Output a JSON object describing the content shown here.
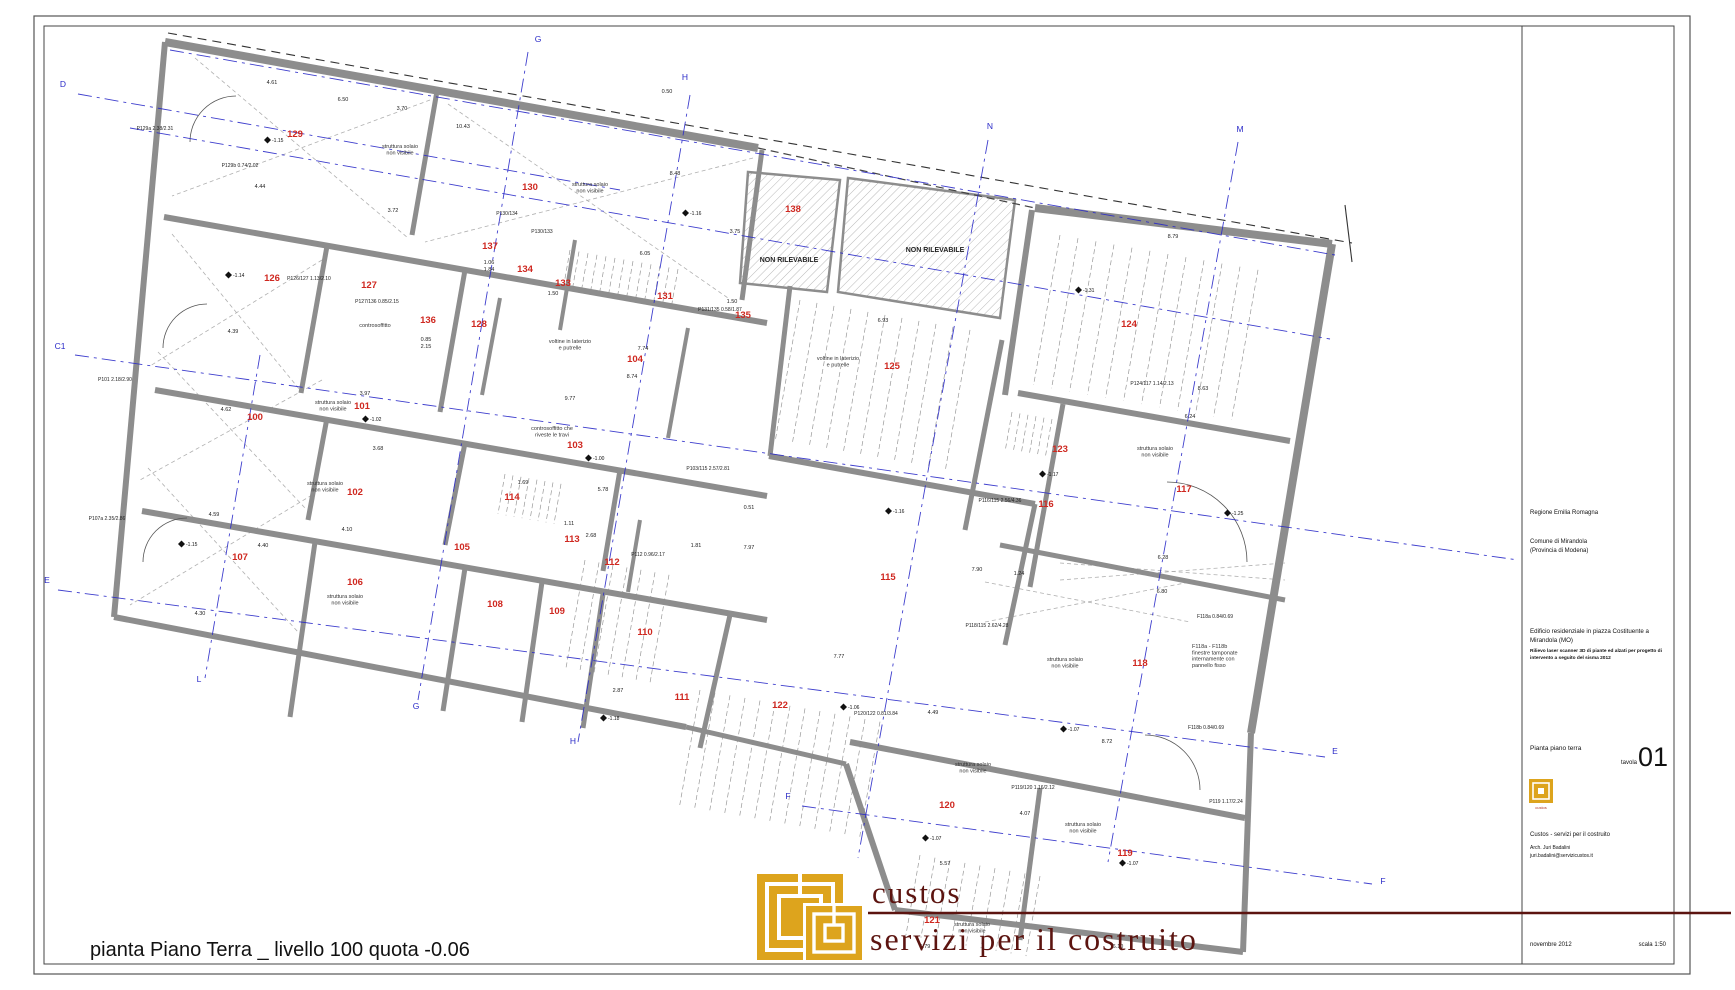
{
  "caption": "pianta Piano Terra _ livello 100 quota -0.06",
  "logo": {
    "line1": "custos",
    "line2": "servizi per il costruito"
  },
  "title_block": {
    "regione": "Regione Emilia Romagna",
    "comune1": "Comune di Mirandola",
    "comune2": "(Provincia di Modena)",
    "title1": "Edificio residenziale in piazza Costituente a",
    "title2": "Mirandola (MO)",
    "sub1": "Rilievo laser scanner 3D di piante ed alzati per progetto di",
    "sub2": "intervento a seguito del sisma 2012",
    "sheet_name": "Pianta piano terra",
    "tavola_label": "tavola",
    "tavola_number": "01",
    "firm": "Custos - servizi per il costruito",
    "architect": "Arch. Juri Badalini",
    "email": "juri.badalini@servizicustos.it",
    "date": "novembre 2012",
    "scale": "scala 1:50",
    "mini_logo_caption": "custos"
  },
  "plan": {
    "rooms": [
      [
        295,
        137,
        "129"
      ],
      [
        530,
        190,
        "130"
      ],
      [
        793,
        212,
        "138"
      ],
      [
        490,
        249,
        "137"
      ],
      [
        525,
        272,
        "134"
      ],
      [
        563,
        286,
        "133"
      ],
      [
        665,
        299,
        "131"
      ],
      [
        743,
        318,
        "135"
      ],
      [
        272,
        281,
        "126"
      ],
      [
        369,
        288,
        "127"
      ],
      [
        428,
        323,
        "136"
      ],
      [
        479,
        327,
        "128"
      ],
      [
        1129,
        327,
        "124"
      ],
      [
        635,
        362,
        "104"
      ],
      [
        892,
        369,
        "125"
      ],
      [
        255,
        420,
        "100"
      ],
      [
        362,
        409,
        "101"
      ],
      [
        575,
        448,
        "103"
      ],
      [
        1060,
        452,
        "123"
      ],
      [
        355,
        495,
        "102"
      ],
      [
        1184,
        492,
        "117"
      ],
      [
        1046,
        507,
        "116"
      ],
      [
        512,
        500,
        "114"
      ],
      [
        462,
        550,
        "105"
      ],
      [
        572,
        542,
        "113"
      ],
      [
        612,
        565,
        "112"
      ],
      [
        888,
        580,
        "115"
      ],
      [
        240,
        560,
        "107"
      ],
      [
        355,
        585,
        "106"
      ],
      [
        495,
        607,
        "108"
      ],
      [
        557,
        614,
        "109"
      ],
      [
        645,
        635,
        "110"
      ],
      [
        1140,
        666,
        "118"
      ],
      [
        682,
        700,
        "111"
      ],
      [
        780,
        708,
        "122"
      ],
      [
        947,
        808,
        "120"
      ],
      [
        1125,
        856,
        "119"
      ],
      [
        932,
        923,
        "121"
      ]
    ],
    "axis_letters": [
      [
        63,
        87,
        "D"
      ],
      [
        538,
        42,
        "G"
      ],
      [
        685,
        80,
        "H"
      ],
      [
        990,
        129,
        "N"
      ],
      [
        1240,
        132,
        "M"
      ],
      [
        60,
        349,
        "C1"
      ],
      [
        47,
        583,
        "E"
      ],
      [
        199,
        682,
        "L"
      ],
      [
        416,
        709,
        "G"
      ],
      [
        573,
        744,
        "H"
      ],
      [
        788,
        799,
        "F"
      ],
      [
        1335,
        754,
        "E"
      ],
      [
        1383,
        884,
        "F"
      ]
    ],
    "annotations": [
      {
        "x": 400,
        "y": 148,
        "t": "struttura solaio\nnon visibile"
      },
      {
        "x": 590,
        "y": 186,
        "t": "struttura solaio\nnon visibile"
      },
      {
        "x": 333,
        "y": 404,
        "t": "struttura solaio\nnon visibile"
      },
      {
        "x": 325,
        "y": 485,
        "t": "struttura solaio\nnon visibile"
      },
      {
        "x": 345,
        "y": 598,
        "t": "struttura solaio\nnon visibile"
      },
      {
        "x": 1155,
        "y": 450,
        "t": "struttura solaio\nnon visibile"
      },
      {
        "x": 1065,
        "y": 661,
        "t": "struttura solaio\nnon visibile"
      },
      {
        "x": 973,
        "y": 766,
        "t": "struttura solaio\nnon visibile"
      },
      {
        "x": 1083,
        "y": 826,
        "t": "struttura solaio\nnon visibile"
      },
      {
        "x": 972,
        "y": 926,
        "t": "struttura solaio\nnon visibile"
      },
      {
        "x": 375,
        "y": 327,
        "t": "controsoffitto"
      },
      {
        "x": 552,
        "y": 430,
        "t": "controsoffitto che\nriveste le travi"
      },
      {
        "x": 570,
        "y": 343,
        "t": "voltine in laterizio\ne putrelle"
      },
      {
        "x": 838,
        "y": 360,
        "t": "voltine in laterizio\ne putrelle"
      },
      {
        "x": 1192,
        "y": 648,
        "t": "F118a - F118b\nfinestre tamponate\ninternamente con\npannello fisso",
        "fs": 4.2,
        "a": "start"
      },
      {
        "x": 789,
        "y": 262,
        "t": "NON RILEVABILE",
        "b": 1
      },
      {
        "x": 935,
        "y": 252,
        "t": "NON RILEVABILE",
        "b": 1
      }
    ],
    "dims": [
      [
        272,
        84,
        "4.61"
      ],
      [
        343,
        101,
        "6.50"
      ],
      [
        402,
        110,
        "3.70"
      ],
      [
        463,
        128,
        "10.43"
      ],
      [
        675,
        175,
        "8.48"
      ],
      [
        260,
        188,
        "4.44"
      ],
      [
        393,
        212,
        "3.72"
      ],
      [
        645,
        255,
        "6.05"
      ],
      [
        735,
        233,
        "3.75"
      ],
      [
        732,
        303,
        "1.50"
      ],
      [
        883,
        322,
        "6.93"
      ],
      [
        1173,
        238,
        "8.79"
      ],
      [
        1190,
        418,
        "6.24"
      ],
      [
        1203,
        390,
        "8.63"
      ],
      [
        632,
        378,
        "8.74"
      ],
      [
        643,
        350,
        "7.74"
      ],
      [
        570,
        400,
        "9.77"
      ],
      [
        365,
        395,
        "3.97"
      ],
      [
        378,
        450,
        "3.68"
      ],
      [
        347,
        531,
        "4.10"
      ],
      [
        200,
        615,
        "4.30"
      ],
      [
        263,
        547,
        "4.40"
      ],
      [
        214,
        516,
        "4.59"
      ],
      [
        226,
        411,
        "4.62"
      ],
      [
        233,
        333,
        "4.39"
      ],
      [
        591,
        537,
        "2.68"
      ],
      [
        569,
        525,
        "1.11"
      ],
      [
        523,
        484,
        "1.69"
      ],
      [
        603,
        491,
        "5.78"
      ],
      [
        749,
        509,
        "0.51"
      ],
      [
        749,
        549,
        "7.97"
      ],
      [
        696,
        547,
        "1.81"
      ],
      [
        839,
        658,
        "7.77"
      ],
      [
        618,
        692,
        "2.87"
      ],
      [
        1162,
        593,
        "6.80"
      ],
      [
        1163,
        559,
        "6.28"
      ],
      [
        1107,
        743,
        "8.72"
      ],
      [
        933,
        714,
        "4.49"
      ],
      [
        945,
        865,
        "5.57"
      ],
      [
        1019,
        575,
        "1.24"
      ],
      [
        977,
        571,
        "7.90"
      ],
      [
        1118,
        948,
        "6.10"
      ],
      [
        925,
        948,
        "5.79"
      ],
      [
        1025,
        815,
        "4.07"
      ],
      [
        667,
        93,
        "0.50"
      ],
      [
        489,
        264,
        "1.06"
      ],
      [
        489,
        271,
        "1.84"
      ],
      [
        553,
        295,
        "1.50"
      ],
      [
        426,
        341,
        "0.85"
      ],
      [
        426,
        348,
        "2.15"
      ]
    ],
    "plabels": [
      [
        155,
        130,
        "P129a 2.38/2.31"
      ],
      [
        240,
        167,
        "P129b 0.74/2.02"
      ],
      [
        309,
        280,
        "P126/127 1.13/2.10"
      ],
      [
        377,
        303,
        "P127/136 0.85/2.15"
      ],
      [
        720,
        311,
        "P131/135 0.58/1.87"
      ],
      [
        115,
        381,
        "P101 2.18/2.90"
      ],
      [
        107,
        520,
        "P107a 2.35/2.86"
      ],
      [
        708,
        470,
        "P103/115 2.57/2.81"
      ],
      [
        1000,
        502,
        "P116/115 2.56/4.36"
      ],
      [
        987,
        627,
        "P118/115 2.62/4.28"
      ],
      [
        876,
        715,
        "P120/122 0.81/3.84"
      ],
      [
        1033,
        789,
        "P119/120 1.16/2.12"
      ],
      [
        1152,
        385,
        "P124/117 1.14/2.13"
      ],
      [
        1226,
        803,
        "P119 1.17/2.24"
      ],
      [
        1215,
        618,
        "F118a 0.84/0.69"
      ],
      [
        1206,
        729,
        "F118b 0.84/0.69"
      ],
      [
        507,
        215,
        "P130/134"
      ],
      [
        542,
        233,
        "P130/133"
      ],
      [
        648,
        556,
        "P112 0.96/2.17"
      ]
    ],
    "spots": [
      [
        272,
        142,
        "-1.15"
      ],
      [
        690,
        215,
        "-1.16"
      ],
      [
        233,
        277,
        "-1.14"
      ],
      [
        370,
        421,
        "-1.02"
      ],
      [
        593,
        460,
        "-1.00"
      ],
      [
        893,
        513,
        "-1.16"
      ],
      [
        1047,
        476,
        "-1.17"
      ],
      [
        1083,
        292,
        "-1.31"
      ],
      [
        1232,
        515,
        "-1.25"
      ],
      [
        1068,
        731,
        "-1.07"
      ],
      [
        930,
        840,
        "-1.07"
      ],
      [
        1127,
        865,
        "-1.07"
      ],
      [
        608,
        720,
        "-1.18"
      ],
      [
        186,
        546,
        "-1.15"
      ],
      [
        848,
        709,
        "-1.06"
      ]
    ],
    "geometry": {
      "outline": "165,42 758,148 1035,208 1332,244 1251,733 1243,952 895,910 846,764 686,727 114,617",
      "walls": [
        [
          165,
          42,
          758,
          148,
          8
        ],
        [
          1035,
          208,
          1332,
          244,
          8
        ],
        [
          165,
          42,
          114,
          617,
          6
        ],
        [
          114,
          617,
          686,
          727,
          6
        ],
        [
          686,
          727,
          846,
          764,
          5
        ],
        [
          1332,
          244,
          1251,
          733,
          8
        ],
        [
          1251,
          733,
          1243,
          952,
          6
        ],
        [
          1243,
          952,
          895,
          910,
          6
        ],
        [
          895,
          910,
          846,
          764,
          6
        ],
        [
          164,
          217,
          767,
          323,
          6
        ],
        [
          155,
          390,
          767,
          496,
          6
        ],
        [
          142,
          511,
          767,
          620,
          6
        ],
        [
          1018,
          393,
          1290,
          441,
          6
        ],
        [
          769,
          456,
          1035,
          504,
          6
        ],
        [
          1000,
          545,
          1285,
          600,
          5
        ],
        [
          850,
          742,
          1245,
          818,
          6
        ],
        [
          437,
          91,
          412,
          235,
          5
        ],
        [
          762,
          150,
          742,
          300,
          5
        ],
        [
          327,
          246,
          301,
          393,
          5
        ],
        [
          465,
          270,
          440,
          412,
          5
        ],
        [
          327,
          418,
          308,
          520,
          5
        ],
        [
          465,
          443,
          445,
          545,
          5
        ],
        [
          620,
          470,
          603,
          571,
          5
        ],
        [
          315,
          542,
          290,
          717,
          5
        ],
        [
          465,
          568,
          443,
          711,
          5
        ],
        [
          542,
          582,
          522,
          722,
          5
        ],
        [
          603,
          594,
          583,
          728,
          5
        ],
        [
          730,
          615,
          700,
          748,
          5
        ],
        [
          1002,
          340,
          965,
          530,
          5
        ],
        [
          1063,
          404,
          1030,
          587,
          5
        ],
        [
          1040,
          788,
          1020,
          940,
          5
        ],
        [
          688,
          328,
          668,
          438,
          4
        ],
        [
          790,
          286,
          770,
          456,
          5
        ],
        [
          1032,
          210,
          1005,
          395,
          6
        ],
        [
          1035,
          504,
          1005,
          645,
          5
        ],
        [
          500,
          298,
          482,
          395,
          4
        ],
        [
          575,
          240,
          560,
          330,
          4
        ],
        [
          640,
          520,
          628,
          592,
          4
        ]
      ],
      "axis_lines": [
        [
          78,
          94,
          620,
          190
        ],
        [
          75,
          355,
          1518,
          560
        ],
        [
          58,
          590,
          1325,
          757
        ],
        [
          802,
          806,
          1372,
          884
        ],
        [
          130,
          128,
          1330,
          339
        ],
        [
          170,
          50,
          1335,
          255
        ],
        [
          260,
          355,
          205,
          678
        ],
        [
          528,
          52,
          418,
          700
        ],
        [
          690,
          95,
          578,
          742
        ],
        [
          988,
          140,
          858,
          858
        ],
        [
          1238,
          142,
          1108,
          862
        ]
      ],
      "thin_lines": [
        [
          168,
          33,
          1352,
          243,
          1
        ],
        [
          1345,
          205,
          1352,
          262,
          0
        ],
        [
          195,
          58,
          408,
          238,
          2
        ],
        [
          430,
          100,
          172,
          196,
          2
        ],
        [
          448,
          104,
          728,
          298,
          2
        ],
        [
          753,
          158,
          425,
          242,
          2
        ],
        [
          172,
          234,
          300,
          390,
          2
        ],
        [
          322,
          260,
          150,
          366,
          2
        ],
        [
          158,
          352,
          305,
          508,
          2
        ],
        [
          322,
          380,
          140,
          480,
          2
        ],
        [
          148,
          468,
          298,
          632,
          2
        ],
        [
          312,
          495,
          130,
          605,
          2
        ],
        [
          985,
          582,
          1190,
          622,
          2
        ],
        [
          985,
          622,
          1190,
          582,
          2
        ],
        [
          1060,
          563,
          1285,
          580,
          2
        ],
        [
          1060,
          580,
          1285,
          563,
          2
        ]
      ],
      "hatches": [
        "748,172 840,180 827,292 740,283",
        "848,178 1015,200 1000,318 838,292"
      ],
      "joists": [
        [
          1060,
          235,
          12,
          18,
          150
        ],
        [
          800,
          300,
          11,
          17,
          140
        ],
        [
          585,
          560,
          7,
          14,
          110
        ],
        [
          700,
          690,
          13,
          15,
          115
        ],
        [
          920,
          855,
          9,
          15,
          80
        ],
        [
          570,
          250,
          13,
          9,
          40
        ],
        [
          505,
          474,
          8,
          8,
          40
        ],
        [
          1012,
          412,
          7,
          8,
          38
        ]
      ],
      "arcs": [
        "M190,142 a46,46 0 0 1 46,-46",
        "M163,348 a44,44 0 0 1 44,-44",
        "M143,562 a44,44 0 0 1 44,-44",
        "M1247,562 a80,80 0 0 0 -80,-80",
        "M1200,790 a55,55 0 0 0 -55,-55"
      ]
    },
    "colors": {
      "wall": "#8d8d8d",
      "axis": "#2a2ac8",
      "room": "#cf2820",
      "logo_red": "#5c1410",
      "logo_yellow": "#dda41d"
    }
  }
}
